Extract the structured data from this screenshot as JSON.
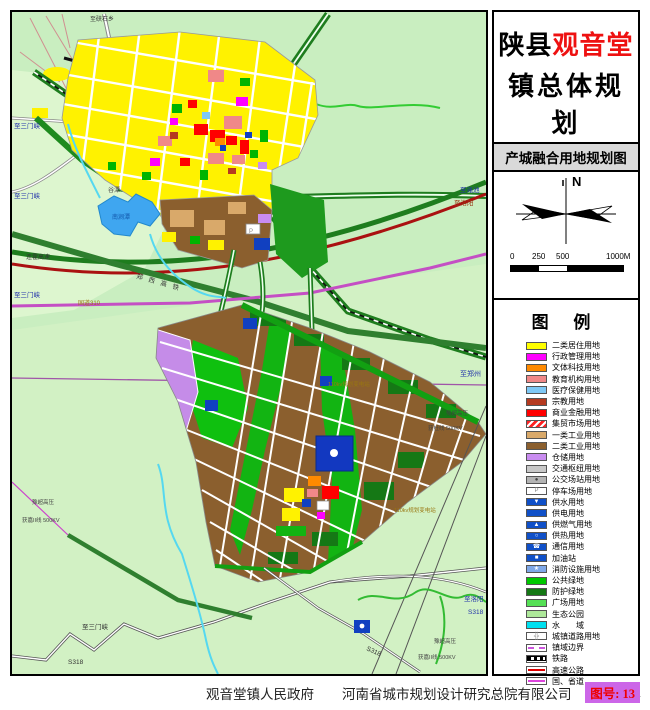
{
  "title": {
    "prefix": "陕县",
    "highlight": "观音堂",
    "line2": "镇总体规划",
    "years": "(2013-2030)",
    "subtitle": "产城融合用地规划图",
    "highlight_color": "#EE1111"
  },
  "compass": {
    "north_label": "N"
  },
  "scalebar": {
    "t0": "0",
    "t1": "250",
    "t2": "500",
    "t3": "1000M"
  },
  "legend": {
    "heading": "图 例",
    "items": [
      {
        "label": "二类居住用地",
        "type": "fill",
        "color": "#FFFF00"
      },
      {
        "label": "行政管理用地",
        "type": "fill",
        "color": "#FF00FF"
      },
      {
        "label": "文体科技用地",
        "type": "fill",
        "color": "#FF8A00"
      },
      {
        "label": "教育机构用地",
        "type": "fill",
        "color": "#F08888"
      },
      {
        "label": "医疗保健用地",
        "type": "fill",
        "color": "#7EC8F5"
      },
      {
        "label": "宗教用地",
        "type": "fill",
        "color": "#B53A20"
      },
      {
        "label": "商业金融用地",
        "type": "fill",
        "color": "#FF0000"
      },
      {
        "label": "集贸市场用地",
        "type": "hatch",
        "color": "#FF2222"
      },
      {
        "label": "一类工业用地",
        "type": "fill",
        "color": "#D9A96A"
      },
      {
        "label": "二类工业用地",
        "type": "fill",
        "color": "#8B5F2E"
      },
      {
        "label": "仓储用地",
        "type": "fill",
        "color": "#C98CF0"
      },
      {
        "label": "交通枢纽用地",
        "type": "fill",
        "color": "#C8C8C8"
      },
      {
        "label": "公交场站用地",
        "type": "icon",
        "color": "#B4B4B4",
        "icon": "●",
        "icon_color": "#444444"
      },
      {
        "label": "停车场用地",
        "type": "icon",
        "color": "#FFFFFF",
        "icon": "P",
        "icon_color": "#888888"
      },
      {
        "label": "供水用地",
        "type": "icon",
        "color": "#1050C8",
        "icon": "▼",
        "icon_color": "#FFFFFF"
      },
      {
        "label": "供电用地",
        "type": "fill",
        "color": "#1050C8"
      },
      {
        "label": "供燃气用地",
        "type": "icon",
        "color": "#1050C8",
        "icon": "▲",
        "icon_color": "#FFFFFF"
      },
      {
        "label": "供热用地",
        "type": "icon",
        "color": "#1050C8",
        "icon": "○",
        "icon_color": "#FFFFFF"
      },
      {
        "label": "通信用地",
        "type": "icon",
        "color": "#1050C8",
        "icon": "☎",
        "icon_color": "#FFFFFF"
      },
      {
        "label": "加油站",
        "type": "icon",
        "color": "#1050C8",
        "icon": "■",
        "icon_color": "#FFFFFF"
      },
      {
        "label": "消防设施用地",
        "type": "icon",
        "color": "#7FA8E8",
        "icon": "★",
        "icon_color": "#FFFFFF"
      },
      {
        "label": "公共绿地",
        "type": "fill",
        "color": "#00C800"
      },
      {
        "label": "防护绿地",
        "type": "fill",
        "color": "#157815"
      },
      {
        "label": "广场用地",
        "type": "fill",
        "color": "#55E055"
      },
      {
        "label": "生态公园",
        "type": "fill",
        "color": "#AEE89A"
      },
      {
        "label": "水　　域",
        "type": "fill",
        "color": "#00E0F0"
      },
      {
        "label": "城镇道路用地",
        "type": "road",
        "color": "#999999"
      },
      {
        "label": "镇域边界",
        "type": "dashline",
        "color": "#CC55DD"
      },
      {
        "label": "铁路",
        "type": "rail",
        "color": "#000000"
      },
      {
        "label": "高速公路",
        "type": "line",
        "color": "#E00000"
      },
      {
        "label": "国、省道",
        "type": "line",
        "color": "#DD44DD"
      }
    ]
  },
  "map": {
    "labels": [
      {
        "t": "至硖石乡",
        "x": 78,
        "y": 9,
        "c": "#333333",
        "s": 6
      },
      {
        "t": "至渑池",
        "x": 448,
        "y": 180,
        "c": "#2233AA",
        "s": 6.5
      },
      {
        "t": "至三门峡",
        "x": 2,
        "y": 116,
        "c": "#2233AA",
        "s": 6.5
      },
      {
        "t": "至三门峡",
        "x": 2,
        "y": 186,
        "c": "#2233AA",
        "s": 6.5
      },
      {
        "t": "连霍高速",
        "x": 14,
        "y": 247,
        "c": "#333333",
        "s": 6
      },
      {
        "t": "至三门峡",
        "x": 2,
        "y": 285,
        "c": "#2233AA",
        "s": 6.5
      },
      {
        "t": "国道310",
        "x": 66,
        "y": 293,
        "c": "#997711",
        "s": 6
      },
      {
        "t": "谷潭",
        "x": 96,
        "y": 180,
        "c": "#444444",
        "s": 6
      },
      {
        "t": "南涧潭",
        "x": 100,
        "y": 207,
        "c": "#1155AA",
        "s": 6
      },
      {
        "t": "郑西高铁",
        "x": 124,
        "y": 266,
        "c": "#333333",
        "s": 6.5,
        "rot": 16,
        "ls": 6
      },
      {
        "t": "至洛阳",
        "x": 442,
        "y": 193,
        "c": "#993311",
        "s": 6.5
      },
      {
        "t": "至郑州",
        "x": 448,
        "y": 364,
        "c": "#2233AA",
        "s": 7
      },
      {
        "t": "豫超高压",
        "x": 434,
        "y": 403,
        "c": "#444444",
        "s": 5.5
      },
      {
        "t": "获杜线 500KV",
        "x": 416,
        "y": 418,
        "c": "#444444",
        "s": 5.5
      },
      {
        "t": "110kv规划变电站",
        "x": 316,
        "y": 374,
        "c": "#997711",
        "s": 5.5
      },
      {
        "t": "110kv规划变电站",
        "x": 382,
        "y": 500,
        "c": "#997711",
        "s": 5.5
      },
      {
        "t": "至洛阳",
        "x": 452,
        "y": 589,
        "c": "#2233AA",
        "s": 6.5
      },
      {
        "t": "S318",
        "x": 456,
        "y": 602,
        "c": "#2233AA",
        "s": 6.5
      },
      {
        "t": "S318",
        "x": 354,
        "y": 638,
        "c": "#333333",
        "s": 6.5,
        "rot": 24
      },
      {
        "t": "豫超高压",
        "x": 422,
        "y": 631,
        "c": "#444444",
        "s": 5.5
      },
      {
        "t": "获嘉II线 500KV",
        "x": 406,
        "y": 647,
        "c": "#444444",
        "s": 5.5
      },
      {
        "t": "豫超高压",
        "x": 20,
        "y": 492,
        "c": "#444444",
        "s": 5.5
      },
      {
        "t": "获嘉II线 500KV",
        "x": 10,
        "y": 510,
        "c": "#444444",
        "s": 5.5
      },
      {
        "t": "至三门峡",
        "x": 70,
        "y": 617,
        "c": "#333333",
        "s": 6.5
      },
      {
        "t": "S318",
        "x": 56,
        "y": 652,
        "c": "#333333",
        "s": 6.5
      },
      {
        "t": "P",
        "x": 237,
        "y": 221,
        "c": "#888888",
        "s": 6
      }
    ]
  },
  "footer": {
    "gov": "观音堂镇人民政府",
    "company": "河南省城市规划设计研究总院有限公司",
    "date": "2014.01",
    "sheet_label": "图号: 13",
    "badge_color": "#CC66E8"
  }
}
